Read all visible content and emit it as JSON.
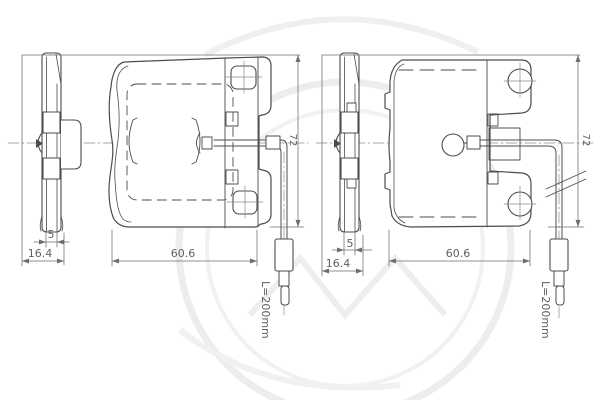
{
  "figure": {
    "type": "brake-pad-technical-drawing",
    "left": {
      "dimensions": {
        "total_thickness": "16.4",
        "friction_thickness": "5",
        "pad_width": "60.6",
        "pad_height": "72",
        "sensor_length": "L=200mm"
      }
    },
    "right": {
      "dimensions": {
        "total_thickness": "16.4",
        "friction_thickness": "5",
        "pad_width": "60.6",
        "pad_height": "72",
        "sensor_length": "L=200mm"
      }
    }
  },
  "colors": {
    "line": "#4c4c4c",
    "dimension": "#6e6e6e",
    "watermark": "#ececec",
    "background": "#ffffff"
  }
}
